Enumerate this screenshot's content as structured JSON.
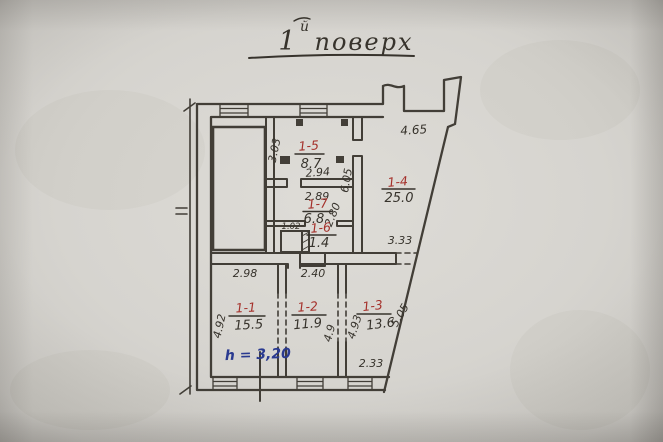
{
  "title": {
    "floor_number": "1",
    "floor_suffix": "й",
    "floor_word": "поверх"
  },
  "rooms": [
    {
      "number": "1-1",
      "area": "15.5"
    },
    {
      "number": "1-2",
      "area": "11.9"
    },
    {
      "number": "1-3",
      "area": "13.6"
    },
    {
      "number": "1-4",
      "area": "25.0"
    },
    {
      "number": "1-5",
      "area": "8.7"
    },
    {
      "number": "1-6",
      "area": "1.4"
    },
    {
      "number": "1-7",
      "area": "6.8"
    }
  ],
  "dimensions": {
    "room5_left": "3.03",
    "room5_bottom": "2.94",
    "room7_top": "2.89",
    "closet_width": "1.02",
    "room6_depth": "2.80",
    "room4_left": "6.05",
    "room4_top": "4.65",
    "room4_bottom": "3.33",
    "room1_top": "2.98",
    "room2_top": "2.40",
    "room1_left": "4.92",
    "room2_depth": "4.9",
    "room3_left": "4.93",
    "room3_slant": "5.05",
    "room3_bottom": "2.33"
  },
  "notes": {
    "ceiling_height": "h = 3,20"
  },
  "colors": {
    "paper": "#d7d5d0",
    "ink": "#37332c",
    "red_ink": "#a5312b",
    "blue_ink": "#2a3a90"
  }
}
